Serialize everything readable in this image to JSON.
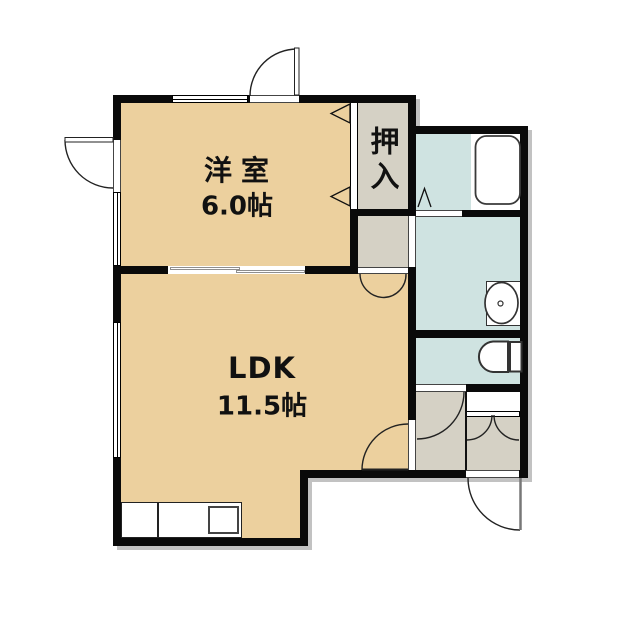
{
  "plan_title": "1LDK apartment floor plan",
  "rooms": {
    "western_room": {
      "name": "洋室",
      "size": "6.0帖"
    },
    "ldk": {
      "name": "LDK",
      "size": "11.5帖"
    },
    "closet": {
      "name": "押入"
    },
    "bathroom": {
      "name": "bathroom"
    },
    "washroom": {
      "name": "washroom"
    },
    "toilet": {
      "name": "toilet"
    },
    "entry": {
      "name": "entry"
    }
  },
  "fixtures": [
    "bathtub",
    "washbasin",
    "toilet",
    "kitchen-counter",
    "kitchen-sink",
    "entry-closet"
  ],
  "colors": {
    "room_tan": "#ecd09e",
    "service_grey": "#d5d1c5",
    "wet_blue": "#cfe3e1",
    "wall": "#0a0a0a",
    "shadow": "#c2c2c2",
    "background": "#ffffff",
    "line": "#222222"
  }
}
